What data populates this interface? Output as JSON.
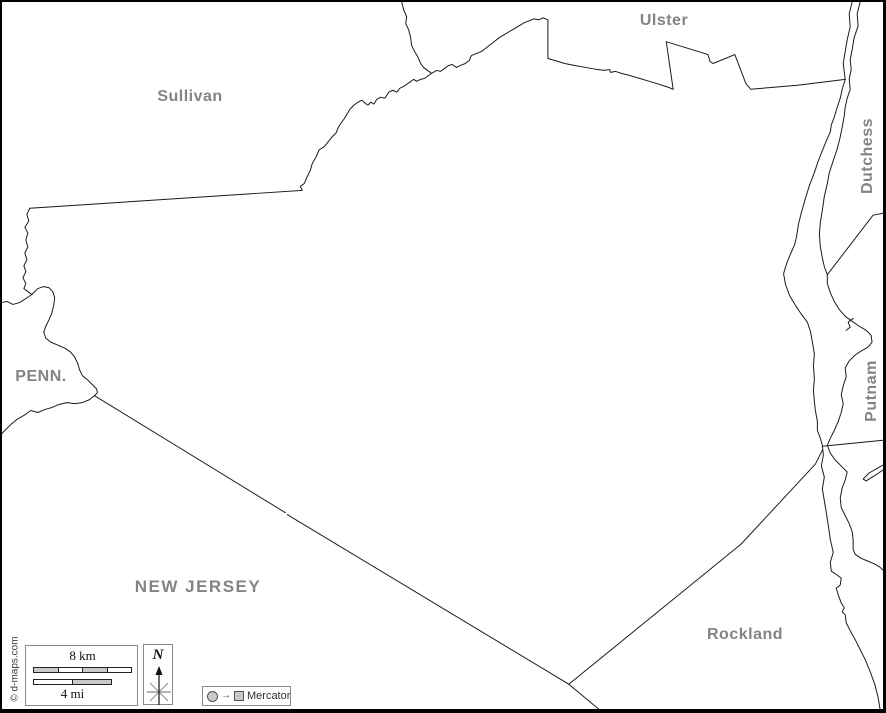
{
  "labels": {
    "sullivan": "Sullivan",
    "ulster": "Ulster",
    "dutchess": "Dutchess",
    "putnam": "Putnam",
    "penn": "PENN.",
    "new_jersey": "NEW JERSEY",
    "rockland": "Rockland"
  },
  "legend": {
    "scale_km": "8 km",
    "scale_mi": "4 mi",
    "north": "N",
    "projection": "Mercator",
    "projection_arrow": "→"
  },
  "credit": "© d-maps.com",
  "colors": {
    "label_gray": "#848484",
    "line": "#1a1a1a",
    "bar_fill": "#c9c9c9"
  }
}
